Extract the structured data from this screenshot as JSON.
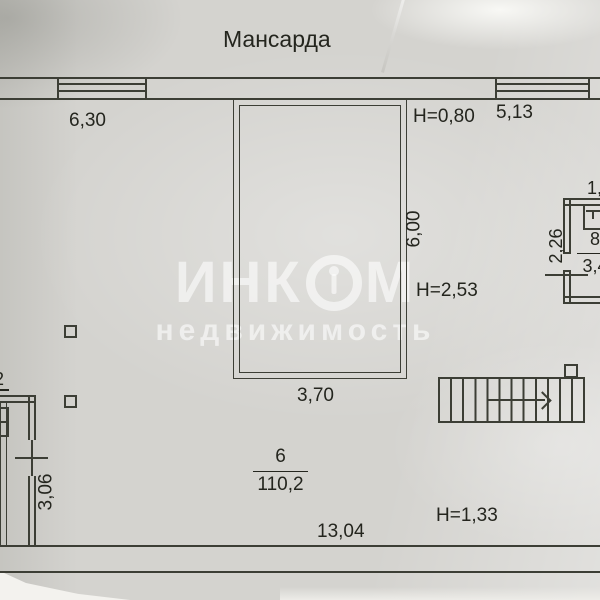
{
  "title": "Мансарда",
  "watermark": {
    "brand_left": "ИНК",
    "brand_right": "М",
    "subtitle": "недвижимость"
  },
  "rooms": {
    "room6": {
      "number": "6",
      "area": "110,2"
    },
    "room8": {
      "number": "8",
      "area": "3,4"
    }
  },
  "dimensions": {
    "top_left_window": "6,30",
    "top_right_window": "5,13",
    "height_top": "Н=0,80",
    "height_middle": "Н=2,53",
    "height_bottom": "Н=1,33",
    "center_width": "3,70",
    "center_height": "6,00",
    "bottom_width": "13,04",
    "left_room_depth": "3,06",
    "room8_height": "2,26",
    "room8_width_partial": "1,",
    "left_edge_partial": "2"
  },
  "colors": {
    "paper": "#d4d3cf",
    "line": "#3c3e35",
    "ink": "#24251e",
    "watermark": "rgba(255,255,255,0.58)"
  }
}
